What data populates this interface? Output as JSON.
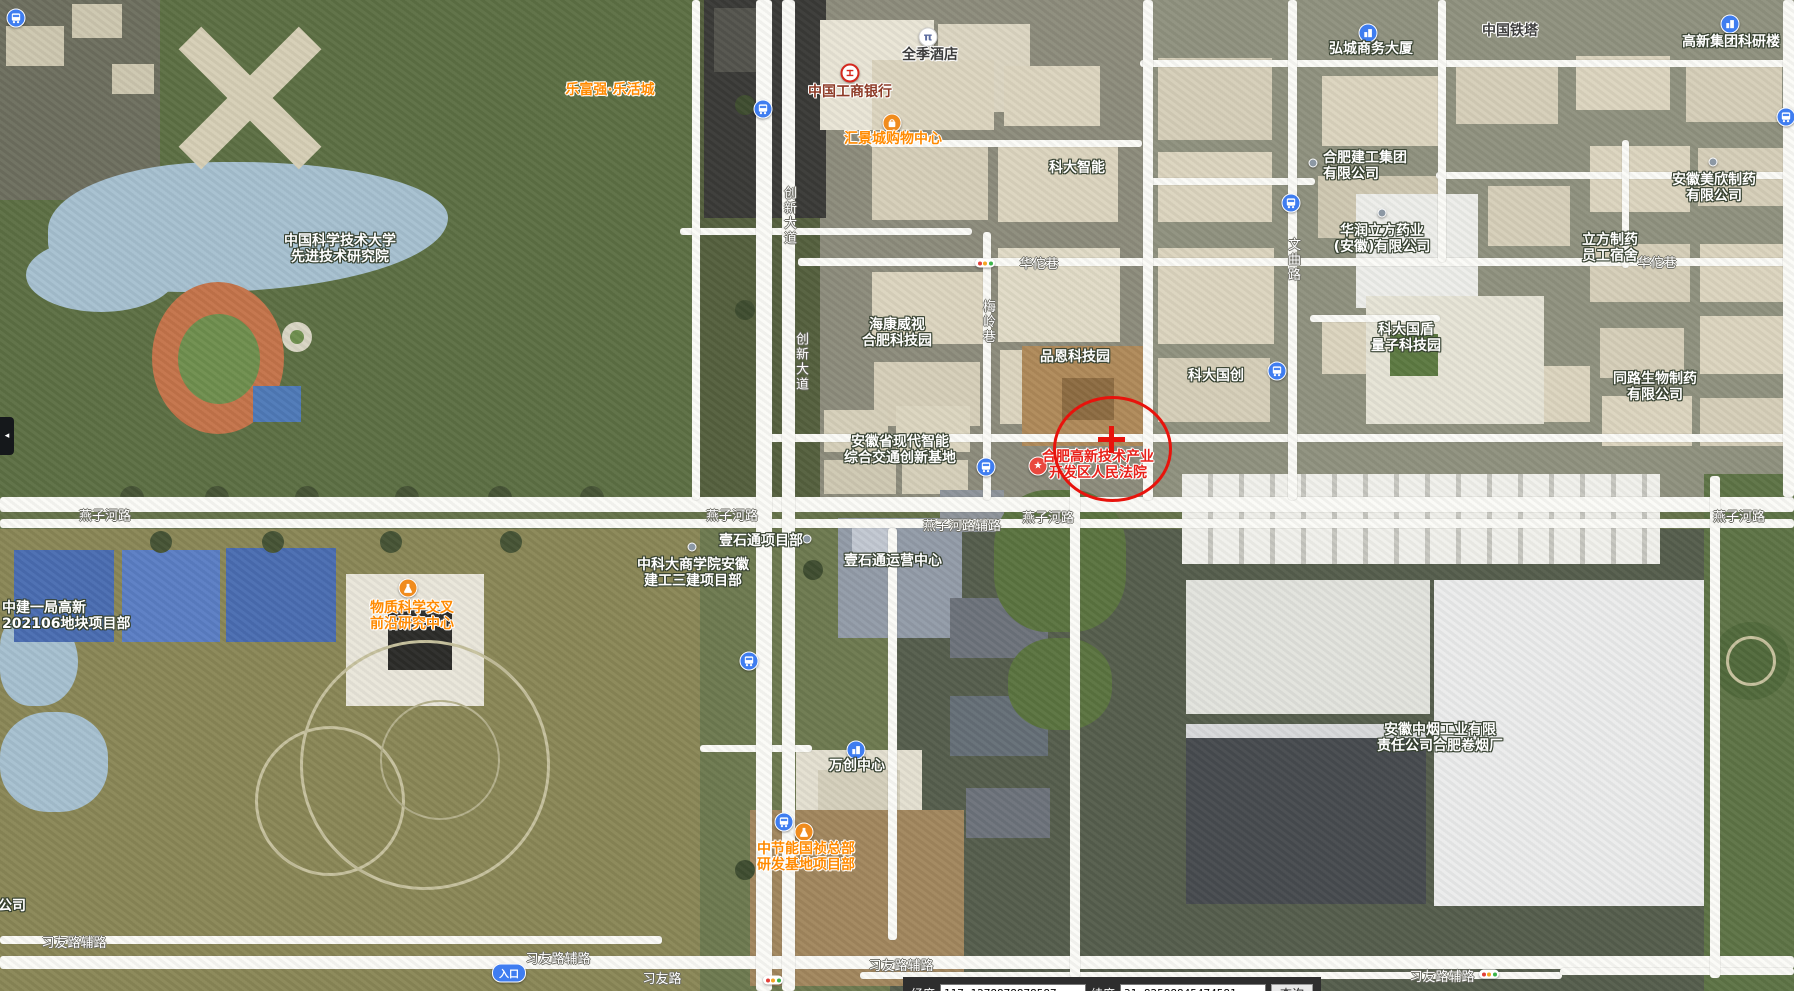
{
  "map": {
    "annotation": {
      "highlight_color": "#e8130c"
    },
    "labels": [
      {
        "name": "ustc-advanced-institute",
        "lines": [
          "中国科学技术大学",
          "先进技术研究院"
        ],
        "x": 340,
        "y": 249,
        "style": "place"
      },
      {
        "name": "lefuqiang-plaza",
        "lines": [
          "乐富强·乐活城"
        ],
        "x": 610,
        "y": 90,
        "style": "place-orange"
      },
      {
        "name": "quanji-hotel",
        "lines": [
          "全季酒店"
        ],
        "x": 930,
        "y": 55,
        "style": "place-dark"
      },
      {
        "name": "icbc-bank",
        "lines": [
          "中国工商银行"
        ],
        "x": 850,
        "y": 92,
        "style": "place-darkred"
      },
      {
        "name": "huijingcheng-mall",
        "lines": [
          "汇景城购物中心"
        ],
        "x": 893,
        "y": 139,
        "style": "place-orange"
      },
      {
        "name": "keda-zhineng",
        "lines": [
          "科大智能"
        ],
        "x": 1077,
        "y": 168,
        "style": "place"
      },
      {
        "name": "hongcheng-business-tower",
        "lines": [
          "弘城商务大厦"
        ],
        "x": 1371,
        "y": 49,
        "style": "place"
      },
      {
        "name": "china-tower",
        "lines": [
          "中国铁塔"
        ],
        "x": 1510,
        "y": 31,
        "style": "place-dark"
      },
      {
        "name": "gaoxin-group-research-building",
        "lines": [
          "高新集团科研楼"
        ],
        "x": 1731,
        "y": 42,
        "style": "place"
      },
      {
        "name": "hefei-construction-group",
        "lines": [
          "合肥建工集团",
          "有限公司"
        ],
        "x": 1323,
        "y": 166,
        "style": "place",
        "align": "left"
      },
      {
        "name": "huarun-lifang-pharma",
        "lines": [
          "华润立方药业",
          "(安徽)有限公司"
        ],
        "x": 1382,
        "y": 239,
        "style": "place"
      },
      {
        "name": "anhui-meixin-pharma",
        "lines": [
          "安徽美欣制药",
          "有限公司"
        ],
        "x": 1714,
        "y": 188,
        "style": "place"
      },
      {
        "name": "lifang-pharma-dorm",
        "lines": [
          "立方制药",
          "员工宿舍"
        ],
        "x": 1610,
        "y": 248,
        "style": "place"
      },
      {
        "name": "hikvision-hefei-park",
        "lines": [
          "海康威视",
          "合肥科技园"
        ],
        "x": 897,
        "y": 333,
        "style": "place"
      },
      {
        "name": "pinen-tech-park",
        "lines": [
          "品恩科技园"
        ],
        "x": 1075,
        "y": 357,
        "style": "place"
      },
      {
        "name": "keda-guochuang",
        "lines": [
          "科大国创"
        ],
        "x": 1216,
        "y": 376,
        "style": "place"
      },
      {
        "name": "keda-guodun-quantum-park",
        "lines": [
          "科大国盾",
          "量子科技园"
        ],
        "x": 1406,
        "y": 338,
        "style": "place"
      },
      {
        "name": "tonglu-bio-pharma",
        "lines": [
          "同路生物制药",
          "有限公司"
        ],
        "x": 1655,
        "y": 387,
        "style": "place"
      },
      {
        "name": "anhui-intelligent-transport-base",
        "lines": [
          "安徽省现代智能",
          "综合交通创新基地"
        ],
        "x": 900,
        "y": 450,
        "style": "place"
      },
      {
        "name": "hefei-hitech-court",
        "lines": [
          "合肥高新技术产业",
          "开发区人民法院"
        ],
        "x": 1098,
        "y": 465,
        "style": "place-red"
      },
      {
        "name": "zhongjian-yiju-project",
        "lines": [
          "中建一局高新",
          "202106地块项目部"
        ],
        "x": 2,
        "y": 616,
        "style": "place",
        "align": "left"
      },
      {
        "name": "material-science-center",
        "lines": [
          "物质科学交叉",
          "前沿研究中心"
        ],
        "x": 412,
        "y": 616,
        "style": "place-orange"
      },
      {
        "name": "ustc-business-school-project",
        "lines": [
          "中科大商学院安徽",
          "建工三建项目部"
        ],
        "x": 693,
        "y": 573,
        "style": "place"
      },
      {
        "name": "yishitong-project",
        "lines": [
          "壹石通项目部"
        ],
        "x": 761,
        "y": 541,
        "style": "place"
      },
      {
        "name": "yishitong-ops-center",
        "lines": [
          "壹石通运营中心"
        ],
        "x": 893,
        "y": 561,
        "style": "place"
      },
      {
        "name": "wanchuang-center",
        "lines": [
          "万创中心"
        ],
        "x": 857,
        "y": 766,
        "style": "place"
      },
      {
        "name": "cecep-guozhen-hq-project",
        "lines": [
          "中节能国祯总部",
          "研发基地项目部"
        ],
        "x": 806,
        "y": 857,
        "style": "place-orange"
      },
      {
        "name": "anhui-tobacco-factory",
        "lines": [
          "安徽中烟工业有限",
          "责任公司合肥卷烟厂"
        ],
        "x": 1440,
        "y": 738,
        "style": "place"
      },
      {
        "name": "truncated-company",
        "lines": [
          "公司"
        ],
        "x": 12,
        "y": 906,
        "style": "place"
      },
      {
        "name": "yanzihe-road-1",
        "lines": [
          "燕子河路"
        ],
        "x": 105,
        "y": 517,
        "style": "road-lbl"
      },
      {
        "name": "yanzihe-road-2",
        "lines": [
          "燕子河路"
        ],
        "x": 732,
        "y": 517,
        "style": "road-lbl"
      },
      {
        "name": "yanzihe-side-road",
        "lines": [
          "燕子河路辅路"
        ],
        "x": 962,
        "y": 527,
        "style": "road-lbl"
      },
      {
        "name": "yanzihe-road-3",
        "lines": [
          "燕子河路"
        ],
        "x": 1048,
        "y": 519,
        "style": "road-lbl"
      },
      {
        "name": "yanzihe-road-4",
        "lines": [
          "燕子河路"
        ],
        "x": 1739,
        "y": 518,
        "style": "road-lbl"
      },
      {
        "name": "xiyou-side-road-1",
        "lines": [
          "习友路辅路"
        ],
        "x": 74,
        "y": 944,
        "style": "road-lbl"
      },
      {
        "name": "xiyou-side-road-2",
        "lines": [
          "习友路辅路"
        ],
        "x": 558,
        "y": 960,
        "style": "road-lbl"
      },
      {
        "name": "xiyou-road",
        "lines": [
          "习友路"
        ],
        "x": 662,
        "y": 980,
        "style": "road-lbl"
      },
      {
        "name": "xiyou-side-road-3",
        "lines": [
          "习友路辅路"
        ],
        "x": 901,
        "y": 967,
        "style": "road-lbl"
      },
      {
        "name": "xiyou-side-road-4",
        "lines": [
          "习友路辅路"
        ],
        "x": 1442,
        "y": 978,
        "style": "road-lbl"
      },
      {
        "name": "huatuo-lane-1",
        "lines": [
          "华佗巷"
        ],
        "x": 1039,
        "y": 265,
        "style": "road-lbl"
      },
      {
        "name": "huatuo-lane-2",
        "lines": [
          "华佗巷"
        ],
        "x": 1657,
        "y": 264,
        "style": "road-lbl"
      },
      {
        "name": "chuangxin-avenue-1",
        "lines": [
          "创新大道"
        ],
        "x": 788,
        "y": 216,
        "style": "road-lbl",
        "vertical": true
      },
      {
        "name": "chuangxin-avenue-2",
        "lines": [
          "创新大道"
        ],
        "x": 800,
        "y": 362,
        "style": "road-lbl",
        "vertical": true
      },
      {
        "name": "meiling-lane",
        "lines": [
          "梅岭巷"
        ],
        "x": 987,
        "y": 322,
        "style": "road-lbl",
        "vertical": true
      },
      {
        "name": "wenqu-road",
        "lines": [
          "文曲路"
        ],
        "x": 1292,
        "y": 260,
        "style": "road-lbl",
        "vertical": true
      }
    ],
    "icons": [
      {
        "type": "bus",
        "x": 16,
        "y": 18
      },
      {
        "type": "bus",
        "x": 763,
        "y": 109
      },
      {
        "type": "bus",
        "x": 1291,
        "y": 203
      },
      {
        "type": "bus",
        "x": 1277,
        "y": 371
      },
      {
        "type": "bus",
        "x": 986,
        "y": 467
      },
      {
        "type": "bus",
        "x": 749,
        "y": 661
      },
      {
        "type": "bus",
        "x": 784,
        "y": 822
      },
      {
        "type": "bus",
        "x": 1786,
        "y": 117
      },
      {
        "type": "hotel",
        "x": 928,
        "y": 37,
        "glyph": "π"
      },
      {
        "type": "bank",
        "x": 850,
        "y": 73
      },
      {
        "type": "shopping",
        "x": 892,
        "y": 123
      },
      {
        "type": "star",
        "x": 1038,
        "y": 466,
        "glyph": "★"
      },
      {
        "type": "flask",
        "x": 408,
        "y": 588
      },
      {
        "type": "flask",
        "x": 804,
        "y": 832
      },
      {
        "type": "building",
        "x": 1368,
        "y": 33
      },
      {
        "type": "building",
        "x": 1730,
        "y": 24
      },
      {
        "type": "building",
        "x": 856,
        "y": 750
      },
      {
        "type": "dot",
        "x": 1313,
        "y": 163
      },
      {
        "type": "dot",
        "x": 1382,
        "y": 213
      },
      {
        "type": "dot",
        "x": 1713,
        "y": 162
      },
      {
        "type": "dot",
        "x": 692,
        "y": 547
      },
      {
        "type": "dot",
        "x": 807,
        "y": 539
      },
      {
        "type": "traffic",
        "x": 985,
        "y": 263
      },
      {
        "type": "traffic",
        "x": 773,
        "y": 980
      },
      {
        "type": "traffic",
        "x": 1489,
        "y": 974
      },
      {
        "type": "entrance",
        "x": 509,
        "y": 973,
        "label": "入口"
      }
    ]
  },
  "statusbar": {
    "lng_label": "经度",
    "lng_value": "117.1278878878587",
    "lat_label": "纬度",
    "lat_value": "31.82588845474581",
    "query_label": "查询"
  },
  "side_toggle": {
    "glyph": "◂"
  }
}
